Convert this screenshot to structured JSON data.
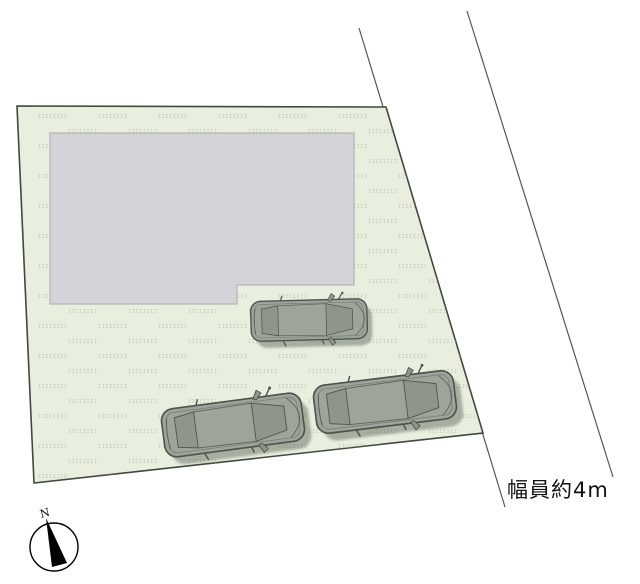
{
  "labels": {
    "road_width": "幅員約4m",
    "compass_north": "N"
  },
  "watermark": {
    "text": "IIIIIIII"
  },
  "colors": {
    "canvas_bg": "#ffffff",
    "plot_fill": "#e8efde",
    "plot_border": "#42483e",
    "building_fill": "#d3d4d7",
    "building_border": "#b3b5b9",
    "car_body": "#9da49a",
    "car_glass": "#8e958b",
    "car_line": "#4e544c",
    "road_line": "#555555",
    "label_text": "#111111",
    "watermark_text": "#a9b49e",
    "compass": "#000000"
  }
}
